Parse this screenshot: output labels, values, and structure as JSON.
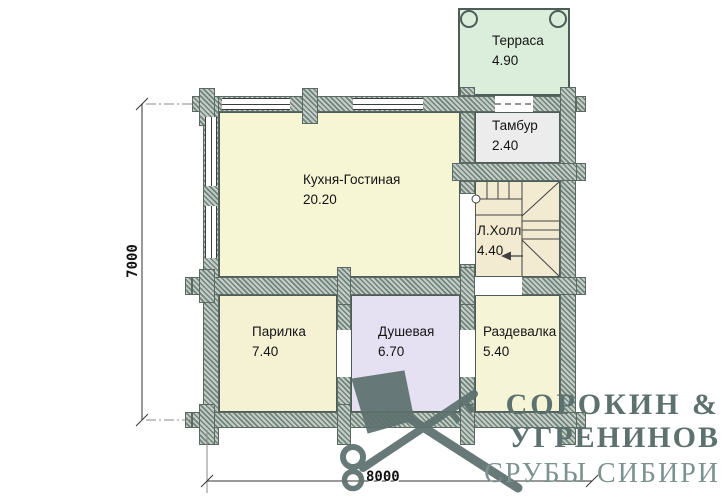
{
  "rooms": {
    "terrace": {
      "name": "Терраса",
      "area": "4.90"
    },
    "tambour": {
      "name": "Тамбур",
      "area": "2.40"
    },
    "kitchen_living": {
      "name": "Кухня-Гостиная",
      "area": "20.20"
    },
    "stair_hall": {
      "name": "Л.Холл",
      "area": "4.40"
    },
    "steam_room": {
      "name": "Парилка",
      "area": "7.40"
    },
    "shower": {
      "name": "Душевая",
      "area": "6.70"
    },
    "dressing_room": {
      "name": "Раздевалка",
      "area": "5.40"
    }
  },
  "dimensions": {
    "height_mm": "7000",
    "width_mm": "8000"
  },
  "logo": {
    "line1": "СОРОКИН &",
    "line2": "УГРЕНИНОВ",
    "tagline": "СРУБЫ СИБИРИ"
  },
  "colors": {
    "wall_hatch_dark": "#71847c",
    "wall_hatch_light": "#c3cdc6",
    "terrace_fill": "#dbeedb",
    "room_yellow_fill": "#f6f5d4",
    "hall_fill": "#f2ebd1",
    "shower_fill": "#e6e0f3",
    "tambour_fill": "#ececec",
    "logo_color": "#5d716e"
  }
}
